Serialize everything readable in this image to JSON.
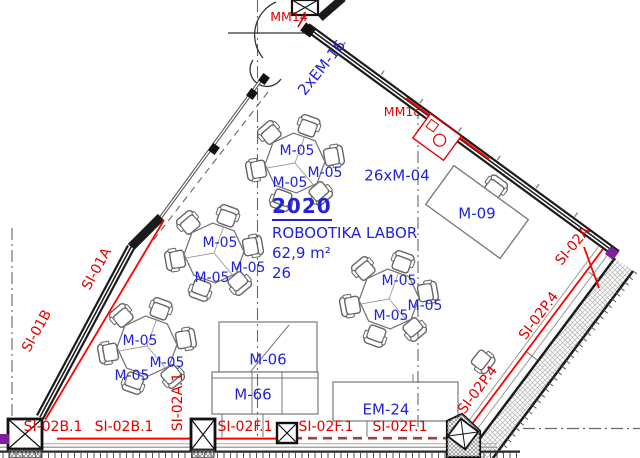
{
  "room": {
    "number": "2020",
    "name": "ROBOOTIKA LABOR",
    "area": "62,9 m²",
    "capacity": "26"
  },
  "furniture": {
    "hex_table_label": "M-05",
    "chairs_label": "26xM-04",
    "desk_label": "M-09",
    "cabinet_label": "M-06",
    "sideboard_label": "M-66",
    "equipment_label": "EM-24",
    "door_label": "2xEM-16"
  },
  "markers": {
    "door_marker": "MM14",
    "wall_marker": "MM1c"
  },
  "wall_labels": {
    "left_upper": "SI-01A",
    "left_lower": "SI-01B",
    "bottom_b1": "SI-02B.1",
    "bottom_b2": "SI-02B.1",
    "vertical_a": "SI-02A.1",
    "bottom_f1": "SI-02F.1",
    "bottom_f2": "SI-02F.1",
    "bottom_f3": "SI-02F.1",
    "corner_a": "SI-02A",
    "right_p1": "SI-02P.4",
    "right_p2": "SI-02P.4"
  },
  "colors": {
    "label_blue": "#2222d8",
    "label_red": "#e30000",
    "line_red": "#ff0000",
    "dash_red": "#9c4040",
    "wall_dark": "#1b1b1b",
    "line_gray": "#777777",
    "accent_purple": "#7d1f9e"
  }
}
